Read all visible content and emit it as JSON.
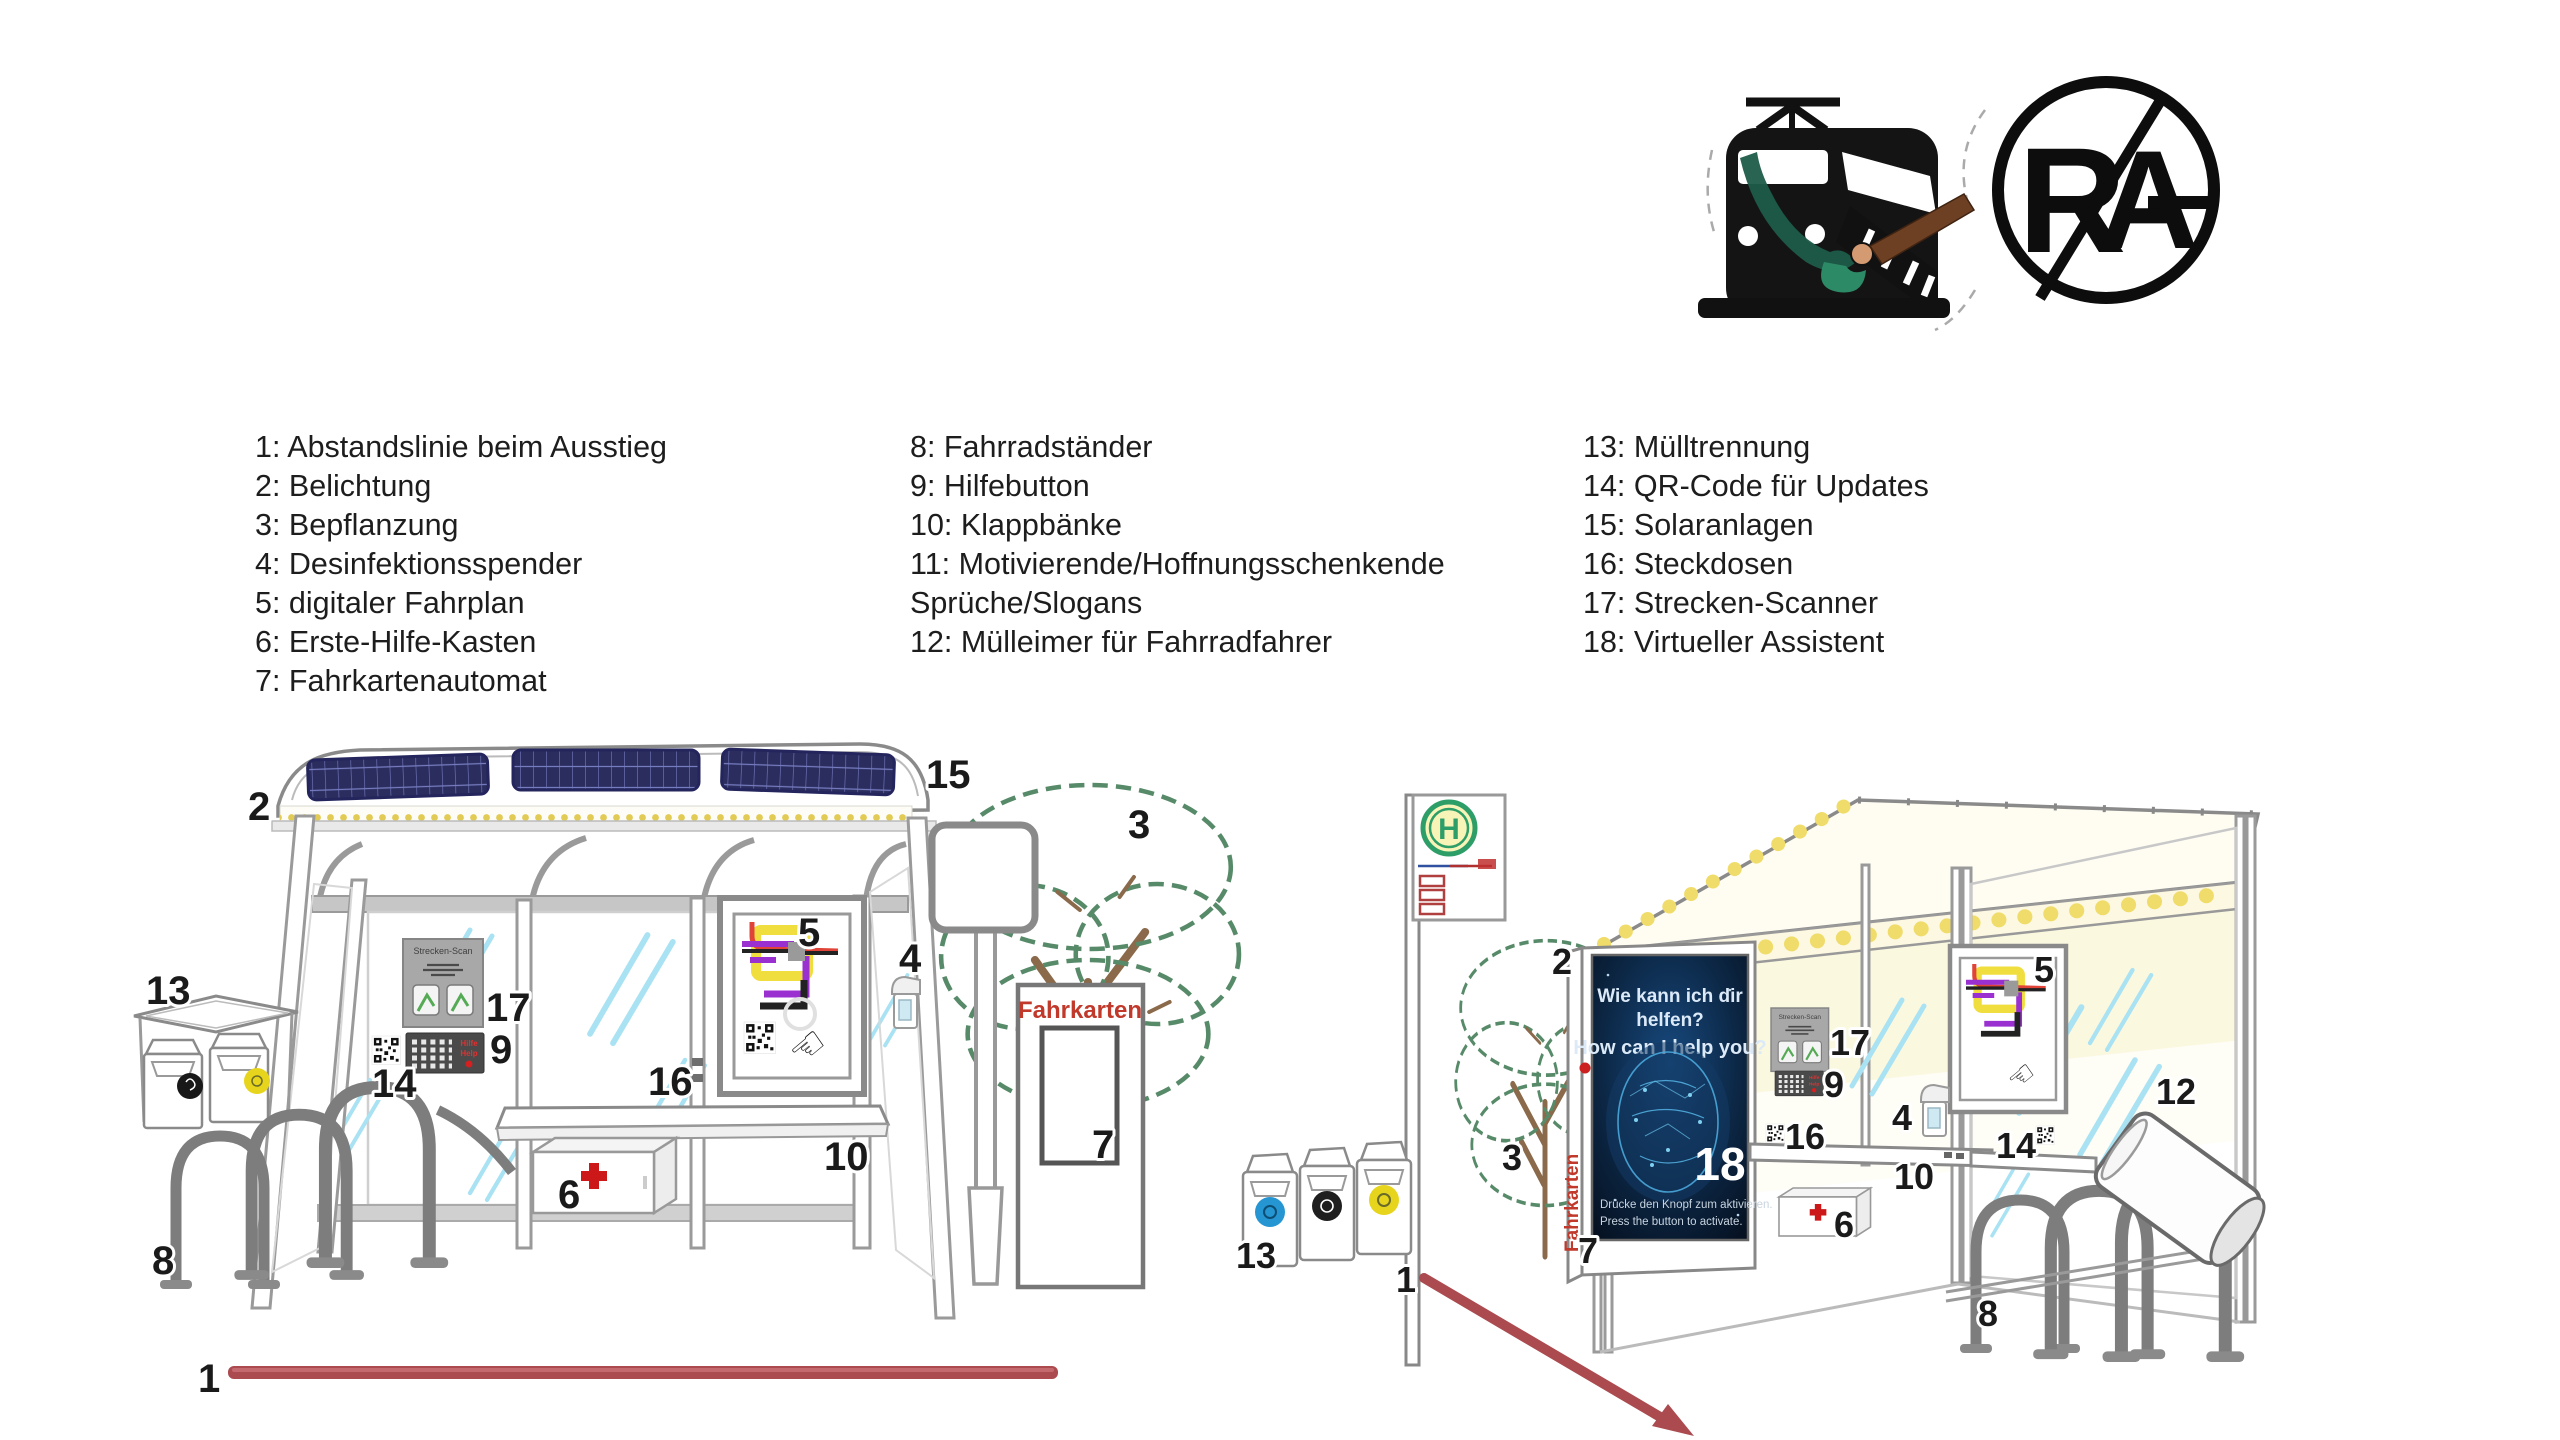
{
  "page": {
    "background": "#ffffff"
  },
  "logos": {
    "rag": {
      "r": "R",
      "a": "A"
    }
  },
  "legend": {
    "columns": [
      {
        "items": [
          "1: Abstandslinie beim Ausstieg",
          "2: Belichtung",
          "3: Bepflanzung",
          "4: Desinfektionsspender",
          "5: digitaler Fahrplan",
          "6: Erste-Hilfe-Kasten",
          "7: Fahrkartenautomat"
        ]
      },
      {
        "items": [
          "8: Fahrradständer",
          "9: Hilfebutton",
          "10: Klappbänke",
          "11: Motivierende/Hoffnungsschenkende Sprüche/Slogans",
          "12: Mülleimer für Fahrradfahrer"
        ]
      },
      {
        "items": [
          "13: Mülltrennung",
          "14: QR-Code für Updates",
          "15: Solaranlagen",
          "16: Steckdosen",
          "17: Strecken-Scanner",
          "18: Virtueller Assistent"
        ]
      }
    ]
  },
  "callouts": {
    "n1": "1",
    "n2": "2",
    "n3": "3",
    "n4": "4",
    "n5": "5",
    "n6": "6",
    "n7": "7",
    "n8": "8",
    "n9": "9",
    "n10": "10",
    "n12": "12",
    "n13": "13",
    "n14": "14",
    "n15": "15",
    "n16": "16",
    "n17": "17",
    "n18": "18"
  },
  "shelter": {
    "strecken_scan_title": "Strecken-Scan",
    "fahrkarten_label": "Fahrkarten",
    "h_sign_letter": "H"
  },
  "keypad": {
    "hilfe": "Hilfe",
    "help": "Help"
  },
  "poster": {
    "title_de_line1": "Wie kann ich dir",
    "title_de_line2": "helfen?",
    "title_en": "How can I help you?",
    "footer_de": "Drücke den Knopf zum aktivieren.",
    "footer_en": "Press the button to activate."
  },
  "icons": {
    "hand_pointer": "☜"
  },
  "colors": {
    "distance_line": "#ab4a4f",
    "solar_panel": "#2b2d5e",
    "led_yellow": "#e8d25c",
    "glass_streak": "#a9e2f3",
    "frame_gray": "#9a9a9a",
    "poster_bg": "#0b2440",
    "poster_accent": "#56b8e8",
    "first_aid_red": "#cc1818",
    "fahrkarten_red": "#c0392b",
    "h_sign_green": "#2e9e68",
    "bin_sticker_blue": "#2596d2",
    "bin_sticker_yellow": "#e6d51c",
    "tree_green": "#578a68",
    "branch_brown": "#8a6a4a"
  }
}
